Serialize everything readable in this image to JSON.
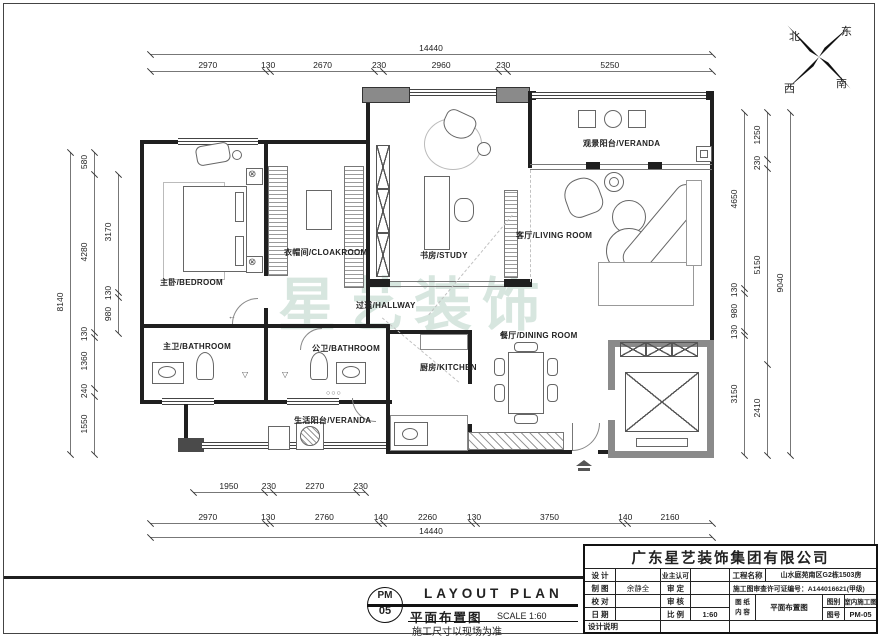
{
  "compass": {
    "north": "北",
    "east": "东",
    "south": "南",
    "west": "西"
  },
  "watermark": "星艺装饰",
  "rooms": [
    {
      "id": "bedroom",
      "label": "主卧/BEDROOM"
    },
    {
      "id": "cloakroom",
      "label": "衣帽间/CLOAKROOM"
    },
    {
      "id": "study",
      "label": "书房/STUDY"
    },
    {
      "id": "veranda-top",
      "label": "观景阳台/VERANDA"
    },
    {
      "id": "living",
      "label": "客厅/LIVING ROOM"
    },
    {
      "id": "hallway",
      "label": "过道/HALLWAY"
    },
    {
      "id": "master-bath",
      "label": "主卫/BATHROOM"
    },
    {
      "id": "public-bath",
      "label": "公卫/BATHROOM"
    },
    {
      "id": "kitchen",
      "label": "厨房/KITCHEN"
    },
    {
      "id": "service-balcony",
      "label": "生活阳台/VERANDA"
    },
    {
      "id": "dining",
      "label": "餐厅/DINING ROOM"
    }
  ],
  "dims": {
    "top_total": "14440",
    "top": [
      "2970",
      "130",
      "2670",
      "230",
      "2960",
      "230",
      "5250"
    ],
    "bottom_inner": [
      "1950",
      "230",
      "2270",
      "230"
    ],
    "bottom": [
      "2970",
      "130",
      "2760",
      "140",
      "2260",
      "130",
      "3750",
      "140",
      "2160"
    ],
    "bottom_total": "14440",
    "left_outer": "8140",
    "left_mid": [
      "580",
      "4280",
      "130",
      "1360",
      "240",
      "1550"
    ],
    "left_inner": [
      "3170",
      "130",
      "980"
    ],
    "right_inner": [
      "4650",
      "130",
      "980",
      "130",
      "3150"
    ],
    "right_mid": [
      "1250",
      "230",
      "5150",
      "2410"
    ],
    "right_outer": "9040"
  },
  "stamp": {
    "code_line1": "PM",
    "code_line2": "05",
    "title_en": "LAYOUT PLAN",
    "title_cn": "平面布置图",
    "scale": "SCALE 1:60",
    "note": "施工尺寸以现场为准"
  },
  "titleblock": {
    "company": "广东星艺装饰集团有限公司",
    "design_label": "设 计",
    "owner_label": "业主认可",
    "project_label": "工程名称",
    "project_value": "山水庭苑南区G2栋1503房",
    "draft_label": "制 图",
    "draft_value": "余静全",
    "approve_label": "审 定",
    "permit": "施工图审查许可证编号：A144016621(甲级)",
    "check_label": "校 对",
    "review_label": "审 核",
    "sheet_label_1": "图 纸",
    "sheet_label_2": "内 容",
    "sheet_value": "平面布置图",
    "type_label": "图别",
    "type_value": "室内施工图",
    "date_label": "日 期",
    "scale_label": "比 例",
    "scale_value": "1:60",
    "no_label": "图号",
    "no_value": "PM-05",
    "note_label": "设计说明"
  }
}
